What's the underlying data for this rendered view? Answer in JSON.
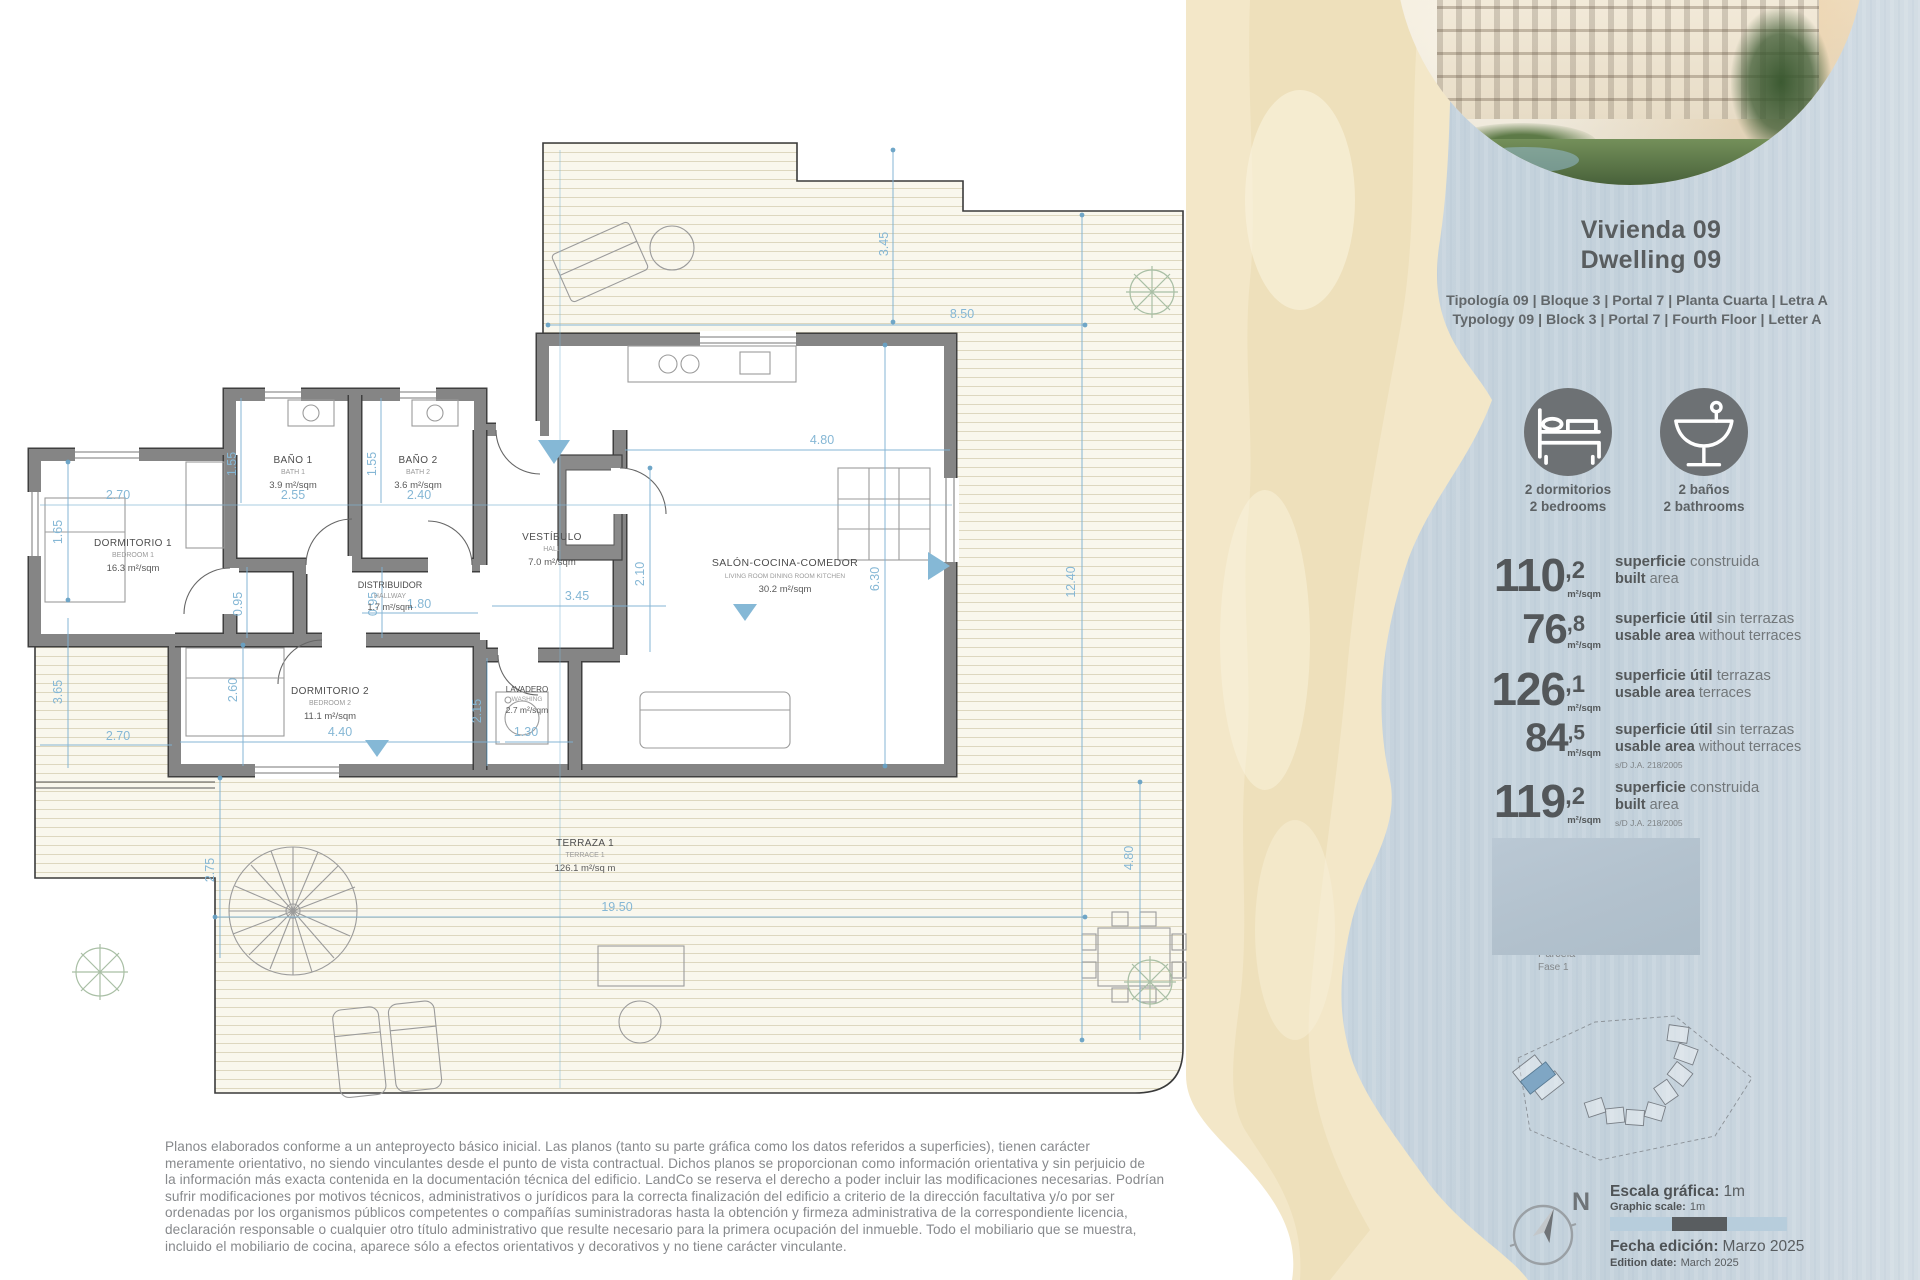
{
  "colors": {
    "dim_blue": "#7fb2d2",
    "wall_gray": "#858585",
    "deck_cream": "#f9f7ed",
    "sand": "#f3e7c8",
    "water": "#c9d6df",
    "accent_dark": "#54585a",
    "icon_circle": "#6d7174",
    "highlight_unit": "#7fa6c4"
  },
  "panel": {
    "title_es": "Vivienda 09",
    "title_en": "Dwelling 09",
    "typology_es": "Tipología 09  |  Bloque 3  |  Portal 7  |  Planta Cuarta  |  Letra A",
    "typology_en": "Typology 09  |  Block 3  |  Portal 7  |  Fourth Floor  |  Letter A",
    "features": [
      {
        "icon": "bed-icon",
        "label_es": "2 dormitorios",
        "label_en": "2 bedrooms"
      },
      {
        "icon": "washbasin-icon",
        "label_es": "2 baños",
        "label_en": "2 bathrooms"
      }
    ],
    "stats": [
      {
        "value": "110",
        "dec": ",2",
        "unit": "m²/sqm",
        "es_b": "superficie",
        "es_r": " construida",
        "en_b": "built",
        "en_r": " area",
        "note": ""
      },
      {
        "value": "76",
        "dec": ",8",
        "unit": "m²/sqm",
        "es_b": "superficie útil",
        "es_r": " sin terrazas",
        "en_b": "usable area",
        "en_r": " without terraces",
        "note": ""
      },
      {
        "value": "126",
        "dec": ",1",
        "unit": "m²/sqm",
        "es_b": "superficie útil",
        "es_r": " terrazas",
        "en_b": "usable area",
        "en_r": " terraces",
        "note": ""
      },
      {
        "value": "84",
        "dec": ",5",
        "unit": "m²/sqm",
        "es_b": "superficie útil",
        "es_r": " sin terrazas",
        "en_b": "usable area",
        "en_r": " without terraces",
        "note": "s/D J.A. 218/2005"
      },
      {
        "value": "119",
        "dec": ",2",
        "unit": "m²/sqm",
        "es_b": "superficie",
        "es_r": " construida",
        "en_b": "built",
        "en_r": " area",
        "note": "s/D J.A. 218/2005"
      }
    ],
    "site": {
      "parcela_label": "Parcela",
      "fase_label": "Fase 1"
    },
    "scale_es_label": "Escala gráfica:",
    "scale_es_value": "1m",
    "scale_en_label": "Graphic scale:",
    "scale_en_value": "1m",
    "edition_es_label": "Fecha edición:",
    "edition_es_value": "Marzo 2025",
    "edition_en_label": "Edition date:",
    "edition_en_value": "March 2025",
    "compass_label": "N"
  },
  "plan": {
    "rooms": [
      {
        "name_es": "DORMITORIO 1",
        "name_en": "BEDROOM 1",
        "area": "16.3 m²/sqm"
      },
      {
        "name_es": "BAÑO 1",
        "name_en": "BATH 1",
        "area": "3.9 m²/sqm"
      },
      {
        "name_es": "BAÑO 2",
        "name_en": "BATH 2",
        "area": "3.6 m²/sqm"
      },
      {
        "name_es": "DISTRIBUIDOR",
        "name_en": "HALLWAY",
        "area": "1.7 m²/sqm"
      },
      {
        "name_es": "VESTÍBULO",
        "name_en": "HALL",
        "area": "7.0 m²/sqm"
      },
      {
        "name_es": "SALÓN-COCINA-COMEDOR",
        "name_en": "LIVING ROOM DINING ROOM KITCHEN",
        "area": "30.2 m²/sqm"
      },
      {
        "name_es": "DORMITORIO 2",
        "name_en": "BEDROOM 2",
        "area": "11.1 m²/sqm"
      },
      {
        "name_es": "LAVADERO",
        "name_en": "WASHING",
        "area": "2.7 m²/sqm"
      },
      {
        "name_es": "TERRAZA 1",
        "name_en": "TERRACE 1",
        "area": "126.1 m²/sq m"
      }
    ],
    "dims": [
      "3.45",
      "8.50",
      "4.80",
      "2.70",
      "1.65",
      "1.55",
      "2.55",
      "1.55",
      "2.40",
      "0.95",
      "0.95",
      "1.80",
      "3.45",
      "2.10",
      "6.30",
      "12.40",
      "2.60",
      "4.40",
      "2.15",
      "1.30",
      "3.65",
      "2.70",
      "19.50",
      "4.80",
      "2.75"
    ]
  },
  "disclaimer": {
    "lines": [
      "Planos elaborados conforme a un anteproyecto básico inicial. Las planos (tanto su parte gráfica como los datos referidos a superficies), tienen carácter",
      "meramente orientativo, no siendo vinculantes desde el punto de vista contractual. Dichos planos se proporcionan como información orientativa y sin perjuicio de",
      "la información más exacta contenida en la documentación técnica del edificio. LandCo se reserva el derecho a poder incluir las modificaciones necesarias. Podrían",
      "sufrir modificaciones por motivos técnicos, administrativos o jurídicos para la correcta finalización del edificio a criterio de la dirección facultativa y/o por ser",
      "ordenadas por los organismos públicos competentes o compañías suministradoras hasta la obtención y firmeza administrativa de la correspondiente licencia,",
      "declaración responsable o cualquier otro título administrativo que resulte necesario para la primera ocupación del inmueble. Todo el mobiliario que se muestra,",
      "incluido el mobiliario de cocina, aparece sólo a efectos orientativos y decorativos y no tiene carácter vinculante."
    ]
  }
}
